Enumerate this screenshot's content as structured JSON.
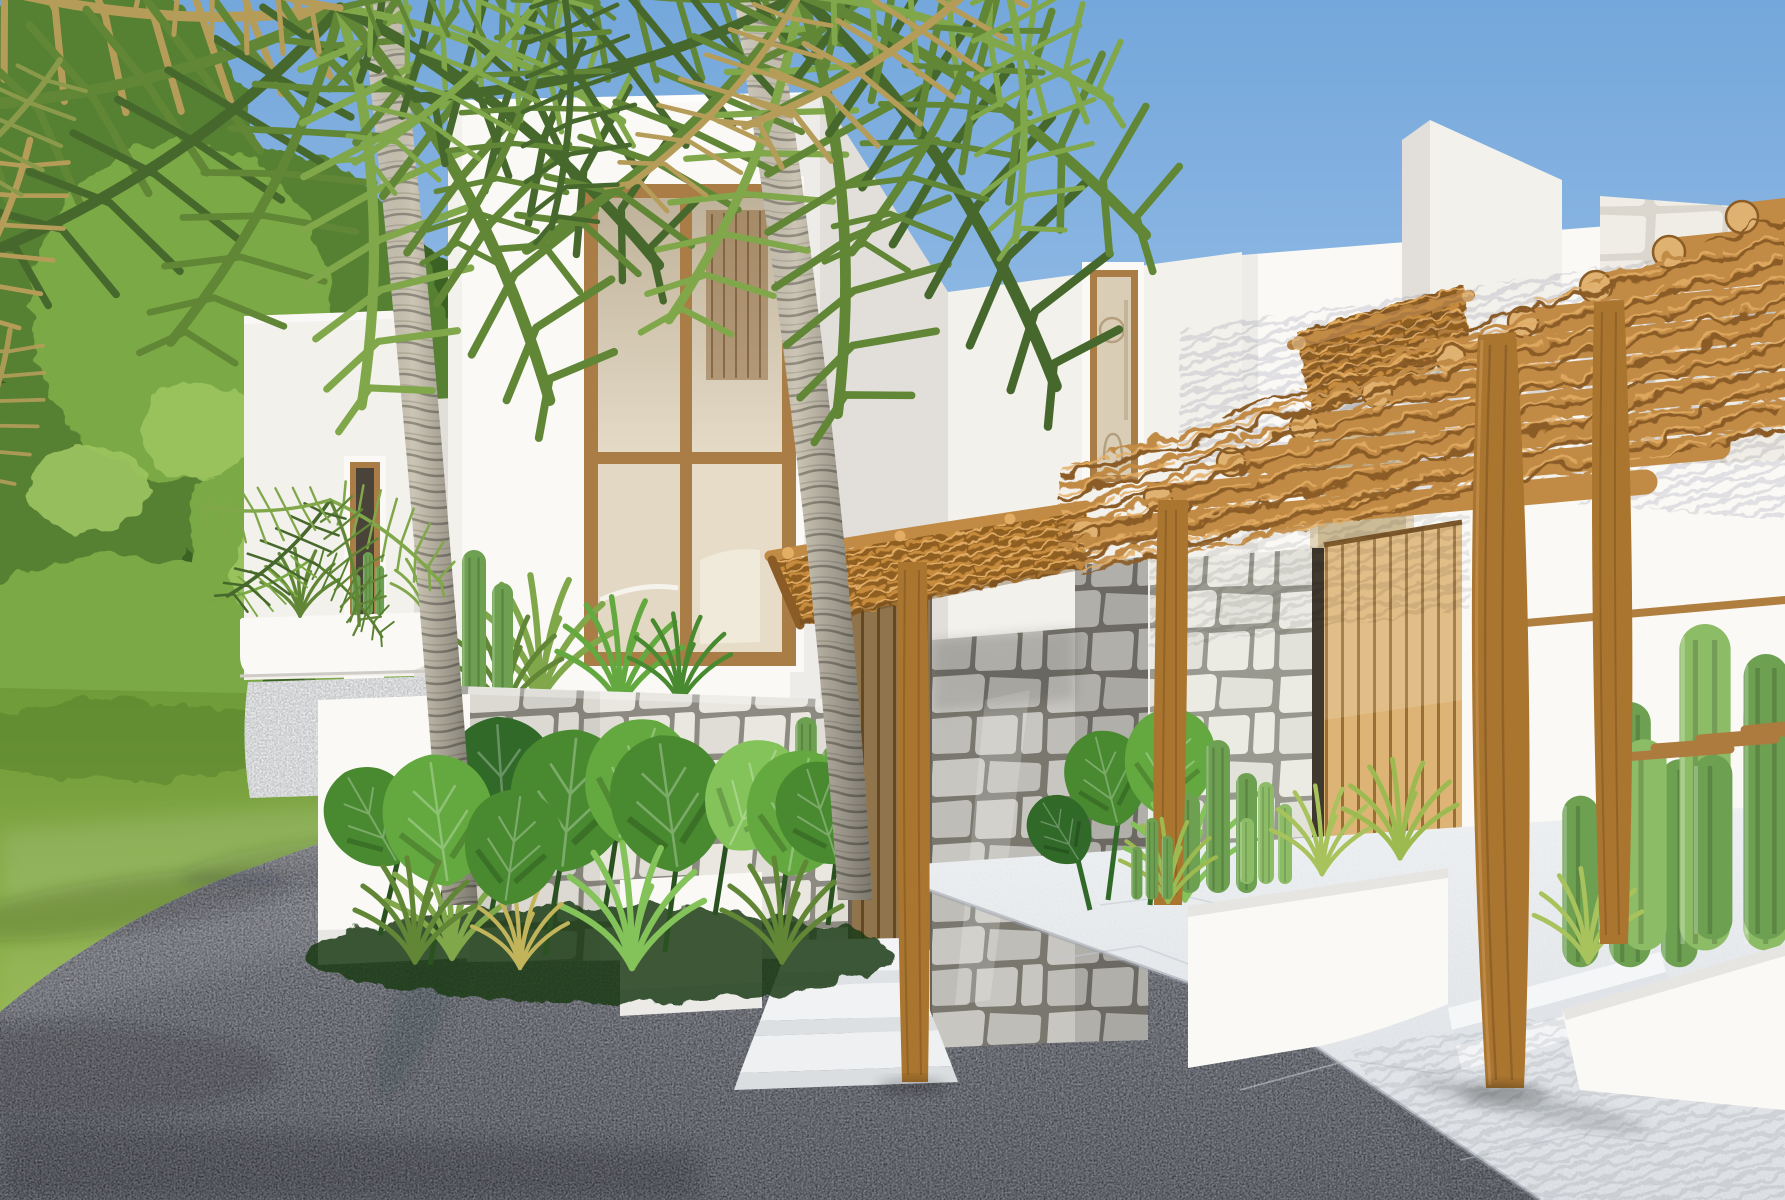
{
  "scene": {
    "caption": "Architectural rendering of a white tropical villa complex: a tall timber-framed window tower, rustic branch pergolas on round wooden posts, rough stone walls, slatted wood doors, palm trees, monstera beds, cacti in white planters, a green lawn and a gray driveway under a clear blue sky."
  },
  "colors": {
    "skyTop": "#74A7DB",
    "skyMid": "#97BEE7",
    "skyHorizon": "#C9DCEF",
    "treeDark": "#3B6224",
    "treeMid": "#578030",
    "treeLight": "#7AA944",
    "treePale": "#9DC560",
    "lawnLit": "#90B24B",
    "lawnMid": "#6F9B39",
    "lawnDark": "#56802C",
    "wallLit": "#F3F1EC",
    "wallBright": "#FAF9F6",
    "wallShade": "#E2DFDA",
    "wallDeep": "#D3D0CB",
    "wallCool": "#DBDADF",
    "creamPanel": "#E3D5B9",
    "woodFrame": "#A97D45",
    "woodFrameDark": "#7D592B",
    "doorSlatLit": "#DDB476",
    "doorSlatDark": "#996F37",
    "pergolaWood": "#C18A45",
    "pergolaLit": "#E3AD64",
    "pergolaDark": "#8B5C26",
    "pergolaCap": "#DFB271",
    "postWood": "#A9752F",
    "postDark": "#7C5220",
    "thatch": "#C68B3D",
    "thatchDark": "#8F5E22",
    "stoneJoint": "#8D8B81",
    "stoneFill": "#E9E7E0",
    "stoneFill2": "#DFDDD5",
    "stoneFaint": "#F0EDE6",
    "stoneFaintJoint": "#DBD7CE",
    "trunkBase": "#CCC5B5",
    "trunkRing": "#5F5C51",
    "frondDark": "#47682C",
    "frondMid": "#608636",
    "frondLight": "#80A749",
    "frondDry": "#B59D59",
    "monsteraDark": "#306928",
    "monsteraMid": "#498930",
    "monsteraLight": "#64A940",
    "monsteraPale": "#83C359",
    "cactus": "#6DA051",
    "cactusLight": "#8DBC67",
    "asphaltTop": "#92959F",
    "asphaltMid": "#737680",
    "asphaltDark": "#5D606B",
    "marble": "#EBEEF0",
    "marbleShade": "#D7DBE0",
    "marbleVein": "#C4CAD0",
    "shadow": "#2F3239"
  }
}
